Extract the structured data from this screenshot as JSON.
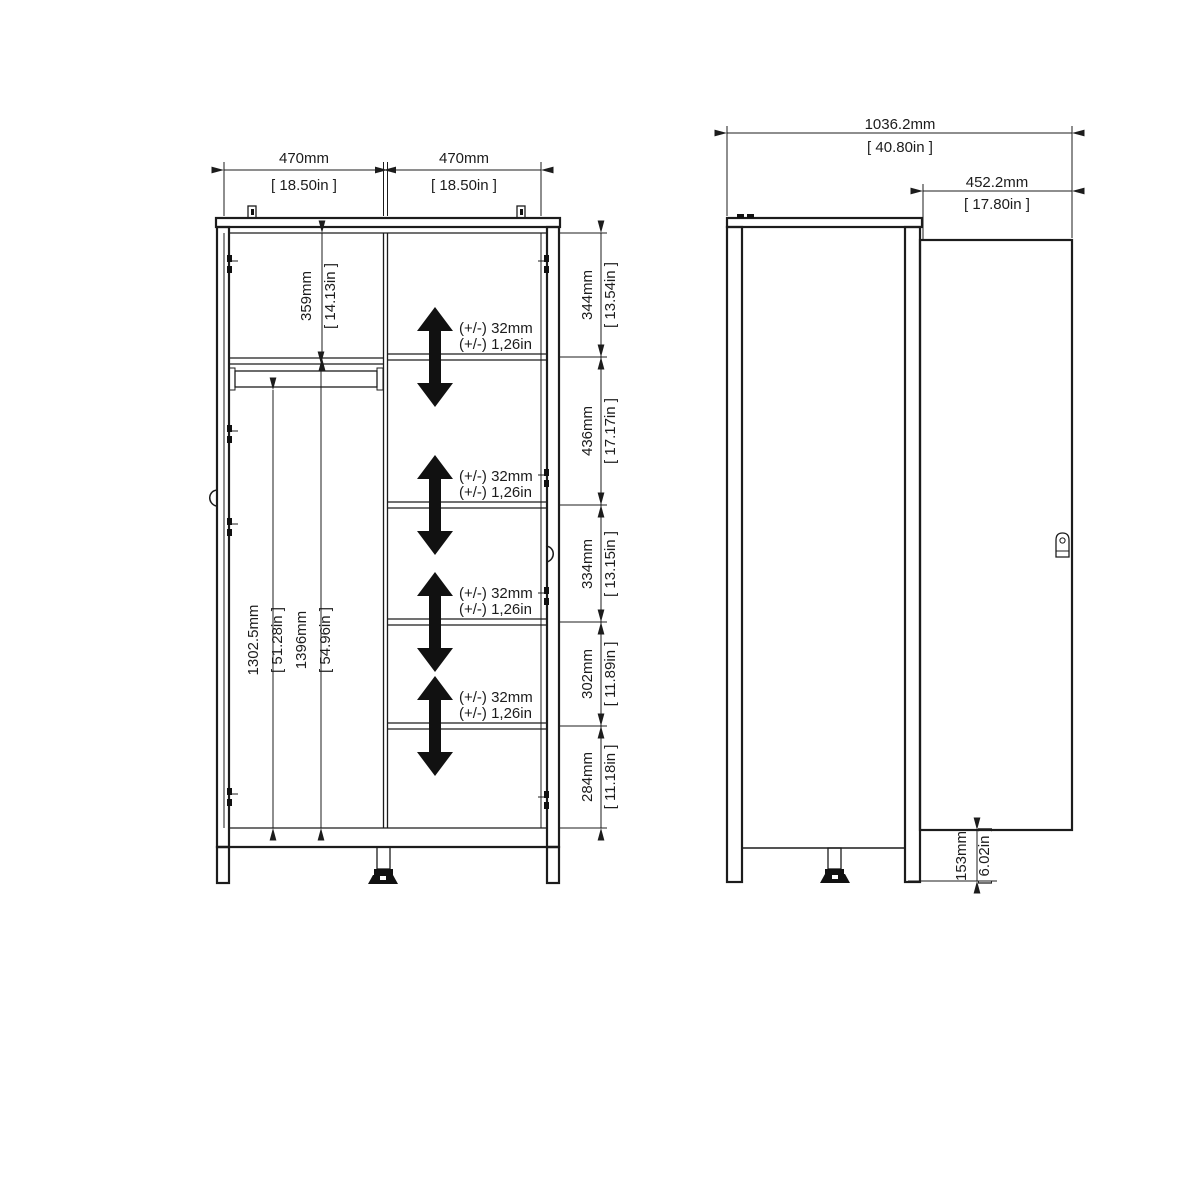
{
  "front_view": {
    "door_width_left": {
      "mm": "470mm",
      "in": "[ 18.50in ]"
    },
    "door_width_right": {
      "mm": "470mm",
      "in": "[ 18.50in ]"
    },
    "top_shelf_height": {
      "mm": "359mm",
      "in": "[ 14.13in ]"
    },
    "rail_clearance": {
      "mm": "1302.5mm",
      "in": "[ 51.28in ]"
    },
    "interior_height": {
      "mm": "1396mm",
      "in": "[ 54.96in ]"
    },
    "shelf_spacings": [
      {
        "mm": "344mm",
        "in": "[ 13.54in ]"
      },
      {
        "mm": "436mm",
        "in": "[ 17.17in ]"
      },
      {
        "mm": "334mm",
        "in": "[ 13.15in ]"
      },
      {
        "mm": "302mm",
        "in": "[ 11.89in ]"
      },
      {
        "mm": "284mm",
        "in": "[ 11.18in ]"
      }
    ],
    "shelf_adjustability": {
      "mm": "(+/-) 32mm",
      "in": "(+/-) 1,26in"
    }
  },
  "side_view": {
    "overall_width": {
      "mm": "1036.2mm",
      "in": "[ 40.80in ]"
    },
    "door_depth": {
      "mm": "452.2mm",
      "in": "[ 17.80in ]"
    },
    "leg_height": {
      "mm": "153mm",
      "in": "[ 6.02in ]"
    }
  },
  "colors": {
    "line": "#1c1c1c",
    "background": "#ffffff"
  }
}
